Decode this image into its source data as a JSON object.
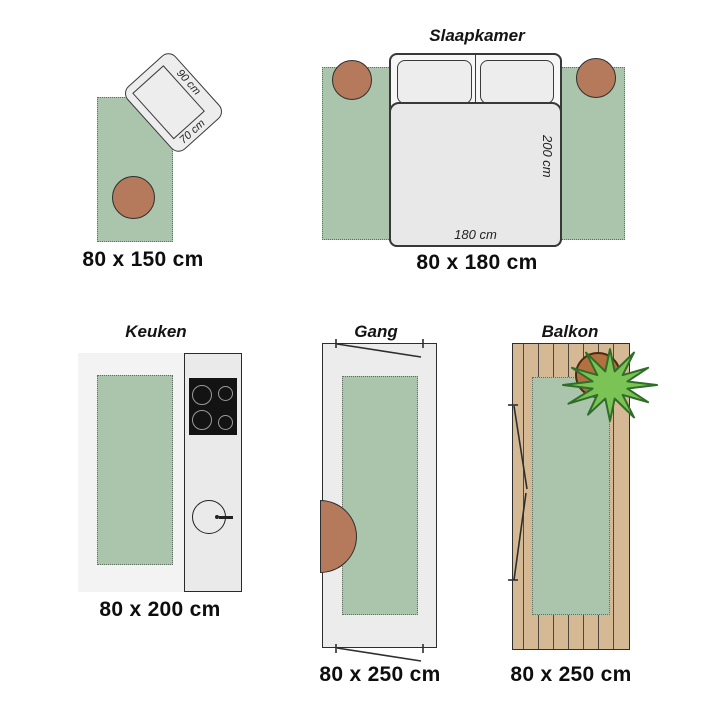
{
  "scenes": {
    "rug_150": {
      "caption": "80 x 150 cm",
      "tilted_rug": {
        "width_label": "90 cm",
        "height_label": "70 cm"
      }
    },
    "bedroom": {
      "title": "Slaapkamer",
      "caption": "80 x 180 cm",
      "bed": {
        "length_label": "200 cm",
        "width_label": "180 cm"
      }
    },
    "kitchen": {
      "title": "Keuken",
      "caption": "80 x 200 cm"
    },
    "hallway": {
      "title": "Gang",
      "caption": "80 x 250 cm"
    },
    "balcony": {
      "title": "Balkon",
      "caption": "80 x 250 cm"
    }
  },
  "colors": {
    "rug_green": "#abc5ad",
    "rug_border_dots": "#5f6f61",
    "pouf_terracotta": "#b57a5c",
    "deck_wood": "#d5b995",
    "plant_leaf": "#7cc355",
    "plant_pot": "#b4713f",
    "outline_dark": "#2e2e2e"
  }
}
